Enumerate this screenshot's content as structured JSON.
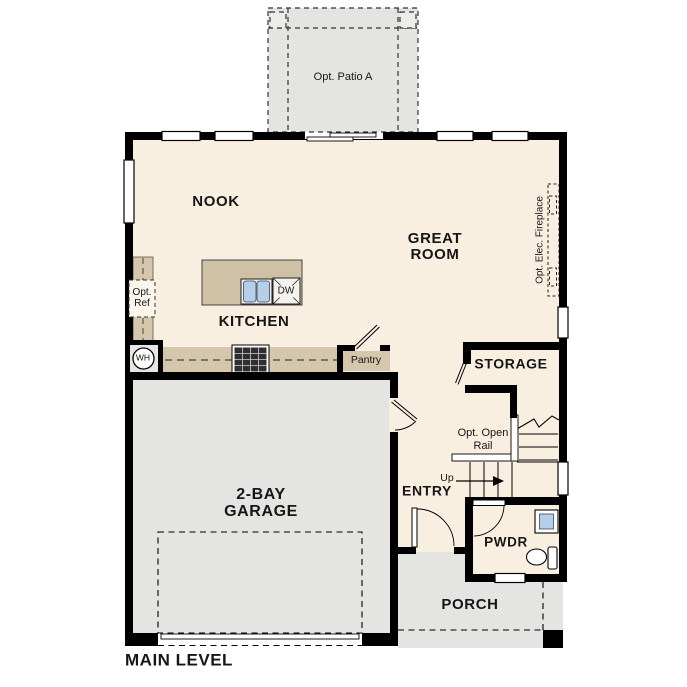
{
  "plan_title": "MAIN LEVEL",
  "colors": {
    "floor": "#f9efe1",
    "concrete": "#e4e4e2",
    "casework": "#d5c7ab",
    "fixture_blue": "#b3cfe9",
    "wall": "#000000"
  },
  "labels": {
    "patio": "Opt. Patio A",
    "nook": "NOOK",
    "great_room_line1": "GREAT",
    "great_room_line2": "ROOM",
    "fireplace": "Opt. Elec. Fireplace",
    "kitchen": "KITCHEN",
    "opt_ref_line1": "Opt.",
    "opt_ref_line2": "Ref",
    "dishwasher": "DW",
    "water_heater": "WH",
    "pantry": "Pantry",
    "storage": "STORAGE",
    "open_rail_line1": "Opt. Open",
    "open_rail_line2": "Rail",
    "up": "Up",
    "entry": "ENTRY",
    "garage_line1": "2-BAY",
    "garage_line2": "GARAGE",
    "pwdr": "PWDR",
    "porch": "PORCH"
  }
}
